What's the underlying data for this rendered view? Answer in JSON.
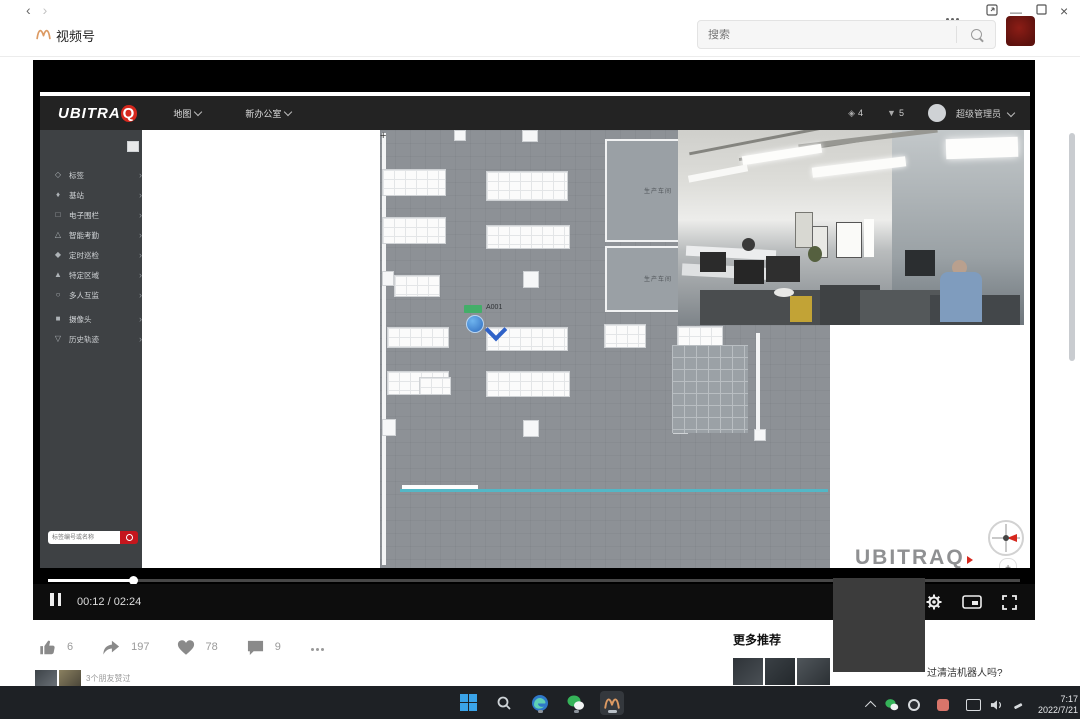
{
  "header": {
    "app_title": "视频号",
    "search_placeholder": "搜索"
  },
  "ubitraq": {
    "brand_main": "UBITRA",
    "brand_q": "Q",
    "menu_map": "地图",
    "menu_site": "新办公室",
    "stat_tags": "4",
    "stat_stations": "5",
    "user_role": "超级管理员",
    "sidebar": [
      {
        "label": "标签"
      },
      {
        "label": "基站"
      },
      {
        "label": "电子围栏"
      },
      {
        "label": "智能考勤"
      },
      {
        "label": "定时巡检"
      },
      {
        "label": "特定区域"
      },
      {
        "label": "多人互监"
      },
      {
        "label": "摄像头"
      },
      {
        "label": "历史轨迹"
      }
    ],
    "tag_search_placeholder": "标签编号或名称",
    "map": {
      "room_right_1": "生产车间",
      "room_right_2": "生产车间",
      "rooms_bottom": [
        "研发测试中心",
        "洽谈厅",
        "办公室",
        "办公室",
        "办公室",
        "会议室"
      ],
      "tag_name": "A001",
      "corner_mark": "+"
    },
    "watermark_en": "UBITRAQ",
    "watermark_cn": "全迹科技",
    "zoom_plus": "+",
    "zoom_minus": "−"
  },
  "player": {
    "time": "00:12 / 02:24"
  },
  "social": {
    "like_count": "6",
    "share_count": "197",
    "heart_count": "78",
    "comment_count": "9"
  },
  "recommend": {
    "title": "更多推荐",
    "first_item_title": "过清洁机器人吗?"
  },
  "friends": {
    "text": "3个朋友赞过"
  },
  "taskbar": {
    "time": "7:17",
    "date": "2022/7/21"
  }
}
